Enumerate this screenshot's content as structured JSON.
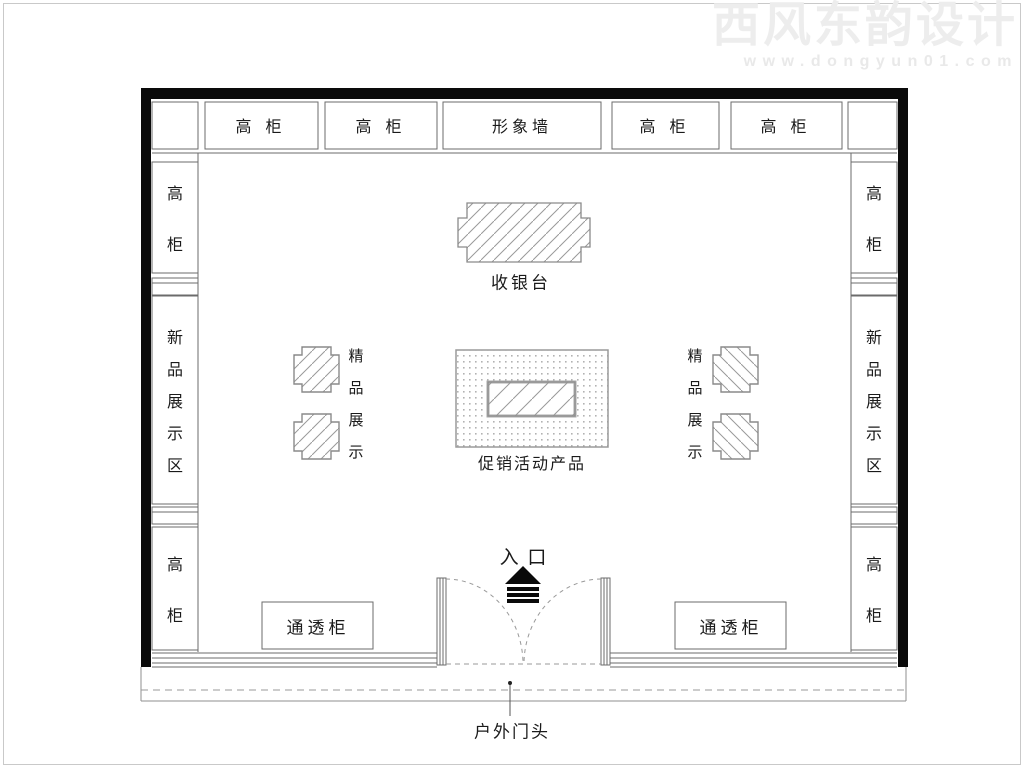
{
  "watermark": {
    "brand": "西风东韵设计",
    "site": "www.dongyun01.com"
  },
  "floor_plan": {
    "top_row": [
      "高 柜",
      "高 柜",
      "形象墙",
      "高 柜",
      "高 柜"
    ],
    "left_wall": {
      "top_cabinet": "高柜",
      "new_product_zone": "新品展示区",
      "bottom_cabinet": "高柜"
    },
    "right_wall": {
      "top_cabinet": "高柜",
      "new_product_zone": "新品展示区",
      "bottom_cabinet": "高柜"
    },
    "cashier_label": "收银台",
    "boutique_left_label": "精品展示",
    "boutique_right_label": "精品展示",
    "promo_label": "促销活动产品",
    "entrance_label": "入 口",
    "showcase_left_label": "通透柜",
    "showcase_right_label": "通透柜",
    "outdoor_sign_label": "户外门头"
  }
}
